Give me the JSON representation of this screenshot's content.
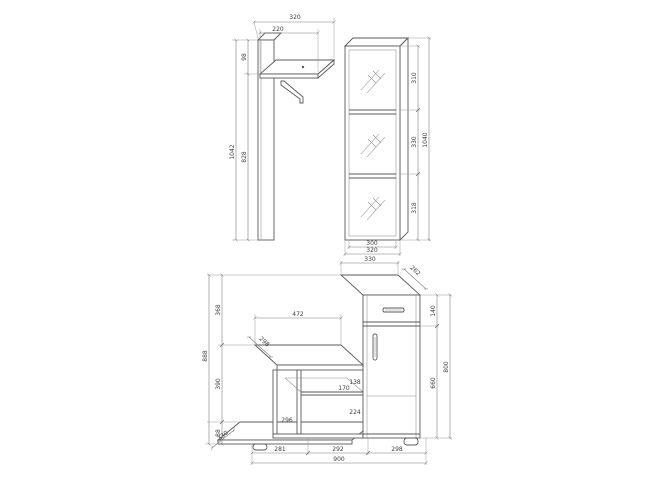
{
  "drawing": {
    "kind": "furniture technical drawing",
    "background": "#ffffff",
    "line_color": "#5a5a5a",
    "dim_color": "#7d7d7d"
  },
  "wall_panel": {
    "name": "wall panel with shelf and coat hook",
    "dims": {
      "total_width": "320",
      "shelf_width": "220",
      "top_to_shelf": "98",
      "total_height": "1042",
      "below_shelf_height": "828"
    }
  },
  "mirror_cabinet": {
    "name": "tall mirror cabinet with three panels",
    "dims": {
      "section_top": "310",
      "section_middle": "330",
      "section_bottom": "318",
      "total_height": "1040",
      "inner_width": "300",
      "outer_width": "320"
    }
  },
  "base_unit": {
    "name": "bench and drawer cabinet combination",
    "dims": {
      "top_width": "330",
      "top_depth": "262",
      "drawer_height": "140",
      "lower_height": "660",
      "right_height": "800",
      "left_height": "888",
      "left_upper": "368",
      "left_lower": "390",
      "plinth_height": "88",
      "plinth_depth": "330",
      "bench_width": "472",
      "bench_depth": "298",
      "shelf_gap_upper": "138",
      "shelf_depth": "170",
      "shelf_gap_lower": "224",
      "left_compartment": "296",
      "bottom_left": "281",
      "bottom_middle": "292",
      "bottom_right": "298",
      "total_width": "900"
    }
  }
}
